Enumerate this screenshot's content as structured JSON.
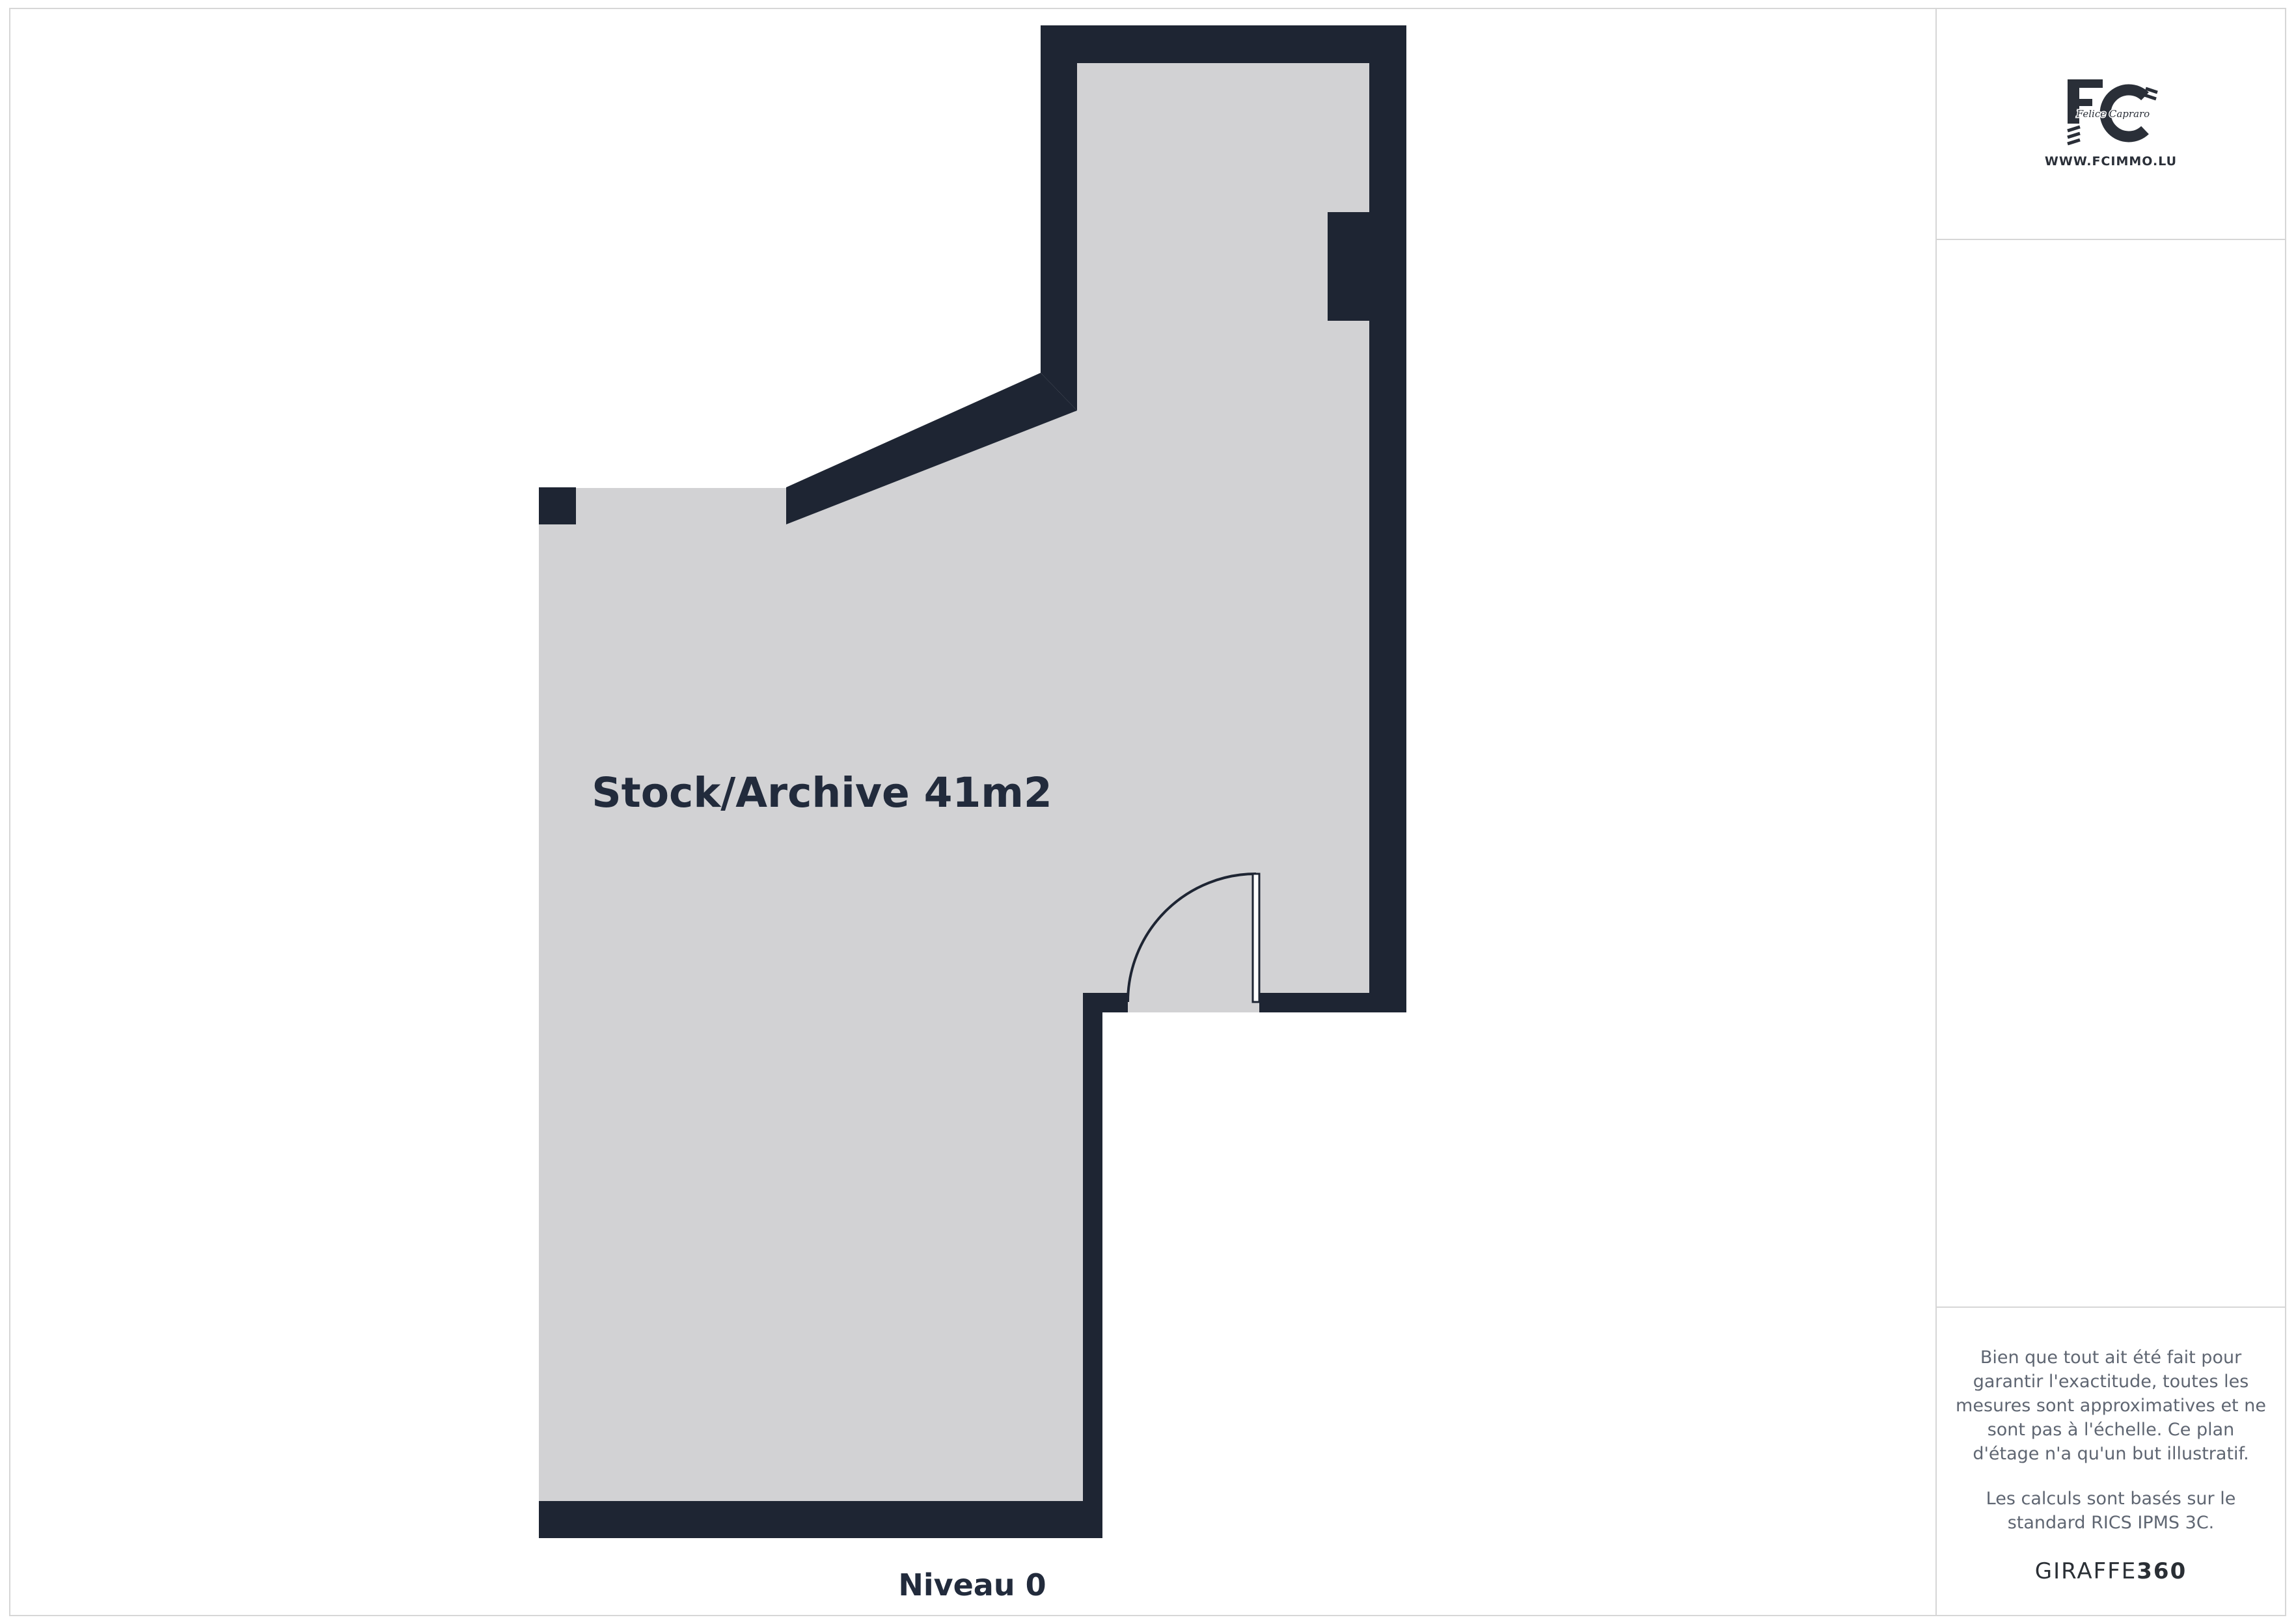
{
  "floorplan": {
    "room_label": "Stock/Archive 41m2",
    "level_label": "Niveau 0",
    "wall_color": "#1e2533",
    "floor_color": "#d2d2d4"
  },
  "sidebar": {
    "logo": {
      "monogram": "FC",
      "script_name": "Felice Capraro",
      "website": "WWW.FCIMMO.LU"
    },
    "disclaimer_p1": "Bien que tout ait été fait pour garantir l'exactitude, toutes les mesures sont approximatives et ne sont pas à l'échelle. Ce plan d'étage n'a qu'un but illustratif.",
    "disclaimer_p2": "Les calculs sont basés sur le standard RICS IPMS 3C.",
    "brand": {
      "name": "GIRAFFE",
      "suffix": "360"
    }
  }
}
